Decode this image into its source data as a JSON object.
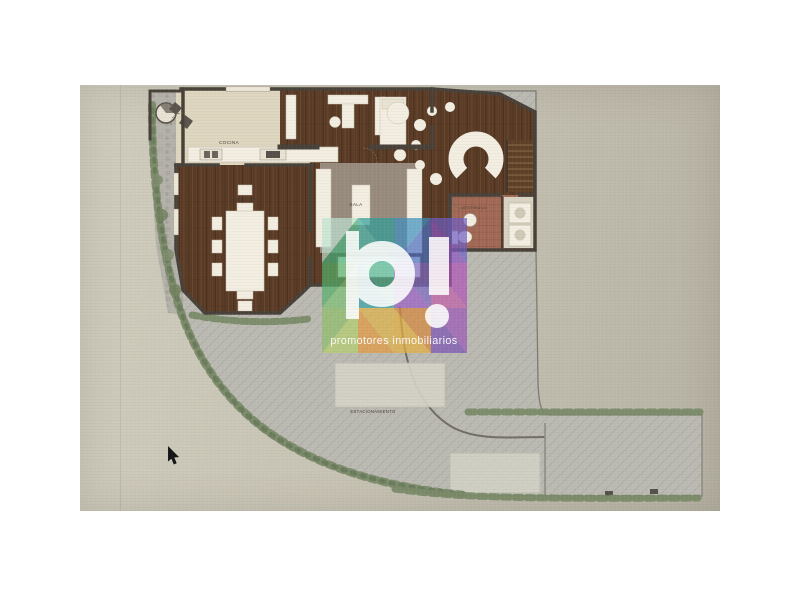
{
  "floor_plan": {
    "rooms": {
      "kitchen_label": "COCINA",
      "dining_label": "COMEDOR",
      "living_label": "SALA",
      "vestibule_label": "VESTIBULO"
    },
    "site": {
      "parking_label": "ESTACIONAMIENTO"
    },
    "colors": {
      "wood_floor": "#5a3b26",
      "walls": "#49423a",
      "kitchen_floor": "#ded6bf",
      "terrace_pavers": "#bcbbb3",
      "vestibule_tile": "#a26a56",
      "hedge_green": "#7a8a68",
      "furniture_white": "#f3eee1",
      "parking_spot": "#d6d4c7"
    }
  },
  "watermark": {
    "letters": "pi",
    "tagline": "promotores inmobiliarios",
    "palette": [
      "#49b07c",
      "#2e9e98",
      "#45b2a4",
      "#3e8fc0",
      "#4a6fc2",
      "#8b54c4",
      "#b052b8",
      "#c25ea8",
      "#7cc274",
      "#e2b447",
      "#e69a3d",
      "#d8873c"
    ]
  },
  "photo": {
    "background_left": "#cfccbd",
    "background_right": "#b6b2a4",
    "page_background": "#ffffff"
  }
}
